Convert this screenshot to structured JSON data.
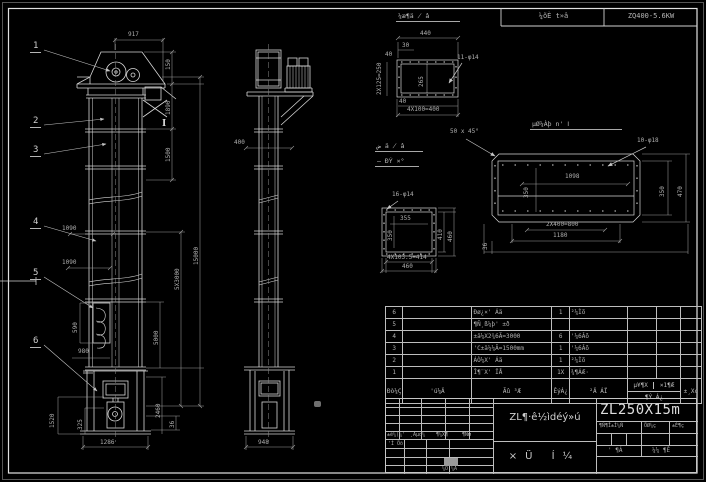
{
  "top_bar": {
    "left_cell": "¼õÈ t»â",
    "right_cell": "ZQ400-5.6KW"
  },
  "front_view": {
    "balloons": [
      "1",
      "2",
      "3",
      "4",
      "5",
      "6"
    ],
    "section_mark": "I",
    "dims": {
      "w917": "917",
      "h150": "150",
      "h1890": "1890",
      "h1500": "1500",
      "h5x3000": "5X3000",
      "h5000": "5000",
      "h15000": "15000",
      "h2460": "2460",
      "h36": "36",
      "w1090_upper": "1090",
      "w1090_lower": "1090",
      "h590": "590",
      "w980": "980",
      "h1520": "1520",
      "h325": "325",
      "w1286": "1286"
    }
  },
  "side_view": {
    "dims": {
      "w400": "400",
      "w948": "948"
    }
  },
  "details": {
    "flange_top": {
      "title": "¼æ¶ä ̸ â",
      "dims": {
        "w440": "440",
        "w30": "30",
        "w40": "40",
        "v250": "2X125=250",
        "v265": "265",
        "holes": "11-φ14",
        "b40": "40",
        "w400": "4X100=400"
      }
    },
    "flange_mid": {
      "title_line1": "ض ä ̸ â",
      "title_line2": "̶ ÐÝ ×°",
      "dims": {
        "holes": "16-φ14",
        "w355": "355",
        "v350": "350",
        "v410": "410",
        "v460": "460",
        "w414": "4X103.5=414",
        "w460": "460"
      }
    },
    "flange_right": {
      "title": "µØ¼Àþ n' Ⅰ",
      "chamfer_note": "50 x 45°",
      "dims": {
        "holes": "10-φ18",
        "w1098": "1098",
        "v350_left": "350",
        "v350_right": "350",
        "v470": "470",
        "w800": "2X400=800",
        "w1180": "1180",
        "v36": "36"
      }
    }
  },
  "bom": {
    "headers": {
      "no": "Ðò¼Ç",
      "code": "'ú¼Ä",
      "name": "Ãû ³Æ",
      "qty": "ÊýÁ¿",
      "material": "²Ä ÁÏ",
      "weight_unit": "µ¥¶X",
      "weight_total": "×1¶Æ",
      "weight_bottom": "¶Ý Á¿",
      "remark": "±¸X¢"
    },
    "rows": [
      {
        "no": "6",
        "code": "",
        "name": "Ðø¿×' Áä",
        "qty": "1",
        "material": "²¼Ìõ",
        "unit": "",
        "total": "",
        "remark": ""
      },
      {
        "no": "5",
        "code": "",
        "name": "¶Ñ¸ß¼þ' ±ð",
        "qty": "",
        "material": "",
        "unit": "",
        "total": "",
        "remark": ""
      },
      {
        "no": "4",
        "code": "",
        "name": "±ä¼X2¾6Ã=3000",
        "qty": "6",
        "material": "'¼6Âõ",
        "unit": "",
        "total": "",
        "remark": ""
      },
      {
        "no": "3",
        "code": "",
        "name": "'C±ä¼¼Ã=1500mm",
        "qty": "1",
        "material": "'¼6Âõ",
        "unit": "",
        "total": "",
        "remark": ""
      },
      {
        "no": "2",
        "code": "",
        "name": "ÁÒ¼X' Áä",
        "qty": "1",
        "material": "²¼Ìõ",
        "unit": "",
        "total": "",
        "remark": ""
      },
      {
        "no": "1",
        "code": "",
        "name": "Î¶¨X' ÎÅ",
        "qty": "1X",
        "material": "¾¶ÁÆ·",
        "unit": "",
        "total": "",
        "remark": ""
      }
    ]
  },
  "title_block": {
    "rev_labels": [
      "±ê¼(¼'",
      "¸Äµd¼",
      "¶¼X¶",
      "¶Ñм"
    ],
    "sig_design": "'Ì Öõ",
    "sig_bottom": "¼Õ ¼Ä",
    "main_title": "ZL¶·ê½ìdéý»ú",
    "sub_title": "×Ü Í¼",
    "model": "ZL250X15m",
    "stage_labels": [
      "¶Ñ¶Î±Ì¼Ñ",
      "ÖØ¼ç",
      "±È¶ç"
    ],
    "sheet_left": "' ¶Á",
    "sheet_right": "¼¼ ¶Ê"
  }
}
